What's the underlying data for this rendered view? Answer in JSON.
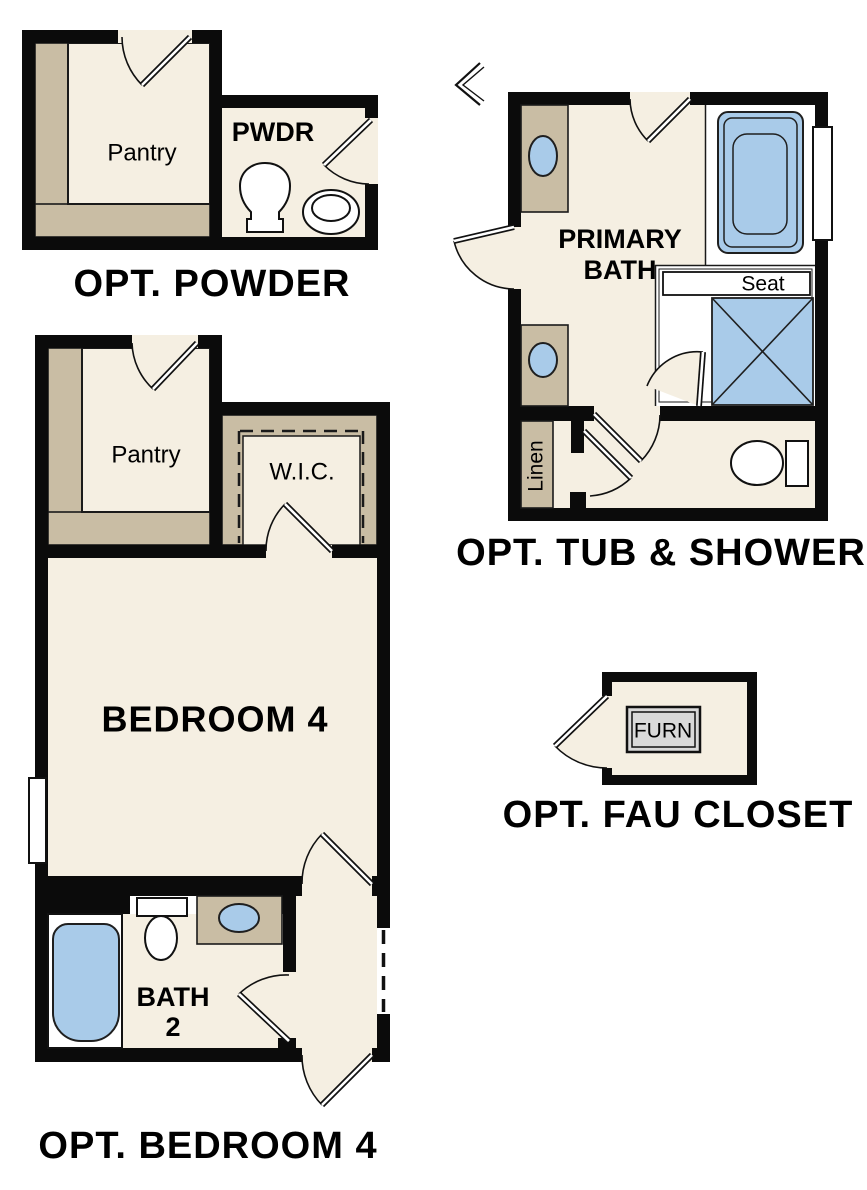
{
  "plans": {
    "powder": {
      "caption": "OPT. POWDER",
      "pantry_label": "Pantry",
      "pwdr_label": "PWDR"
    },
    "tub_shower": {
      "caption": "OPT. TUB & SHOWER",
      "primary_line1": "PRIMARY",
      "primary_line2": "BATH",
      "seat_label": "Seat",
      "linen_label": "Linen"
    },
    "bedroom4": {
      "caption": "OPT. BEDROOM 4",
      "pantry_label": "Pantry",
      "wic_label": "W.I.C.",
      "bedroom_label": "BEDROOM 4",
      "bath_line1": "BATH",
      "bath_line2": "2"
    },
    "fau": {
      "caption": "OPT. FAU CLOSET",
      "furn_label": "FURN"
    }
  },
  "colors": {
    "floor_cream": "#f5efe2",
    "counter_tan": "#c9bda4",
    "fixture_blue": "#a9cbe9",
    "wall_black": "#0b0b0b",
    "furnace_gray": "#d9d9d9",
    "background": "#ffffff"
  }
}
